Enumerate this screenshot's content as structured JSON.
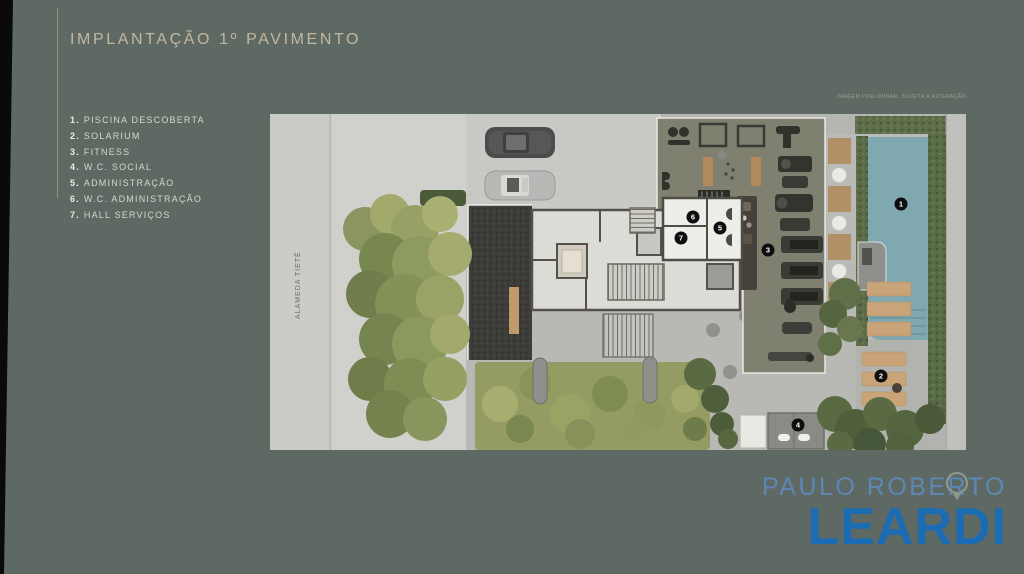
{
  "meta": {
    "background_color": "#5f6963",
    "accent_beige": "#c3b79f",
    "edge_strip_color": "#0a0a0a"
  },
  "header": {
    "title": "IMPLANTAÇÃO 1º PAVIMENTO"
  },
  "legend": {
    "items": [
      {
        "num": "1.",
        "label": "PISCINA DESCOBERTA"
      },
      {
        "num": "2.",
        "label": "SOLARIUM"
      },
      {
        "num": "3.",
        "label": "FITNESS"
      },
      {
        "num": "4.",
        "label": "W.C. SOCIAL"
      },
      {
        "num": "5.",
        "label": "ADMINISTRAÇÃO"
      },
      {
        "num": "6.",
        "label": "W.C. ADMINISTRAÇÃO"
      },
      {
        "num": "7.",
        "label": "HALL SERVIÇOS"
      }
    ]
  },
  "plan": {
    "disclaimer": "IMAGEM PRELIMINAR. SUJEITA A ALTERAÇÃO.",
    "street_label": "ALAMEDA TIETÊ",
    "pool_color": "#7fa8b0",
    "markers": [
      {
        "n": "1"
      },
      {
        "n": "2"
      },
      {
        "n": "3"
      },
      {
        "n": "4"
      },
      {
        "n": "5"
      },
      {
        "n": "6"
      },
      {
        "n": "7"
      }
    ]
  },
  "logo": {
    "line1": "PAULO ROBERTO",
    "line2": "LEARDI",
    "color_line1": "#5d87b6",
    "color_line2": "#1c6cb4"
  }
}
